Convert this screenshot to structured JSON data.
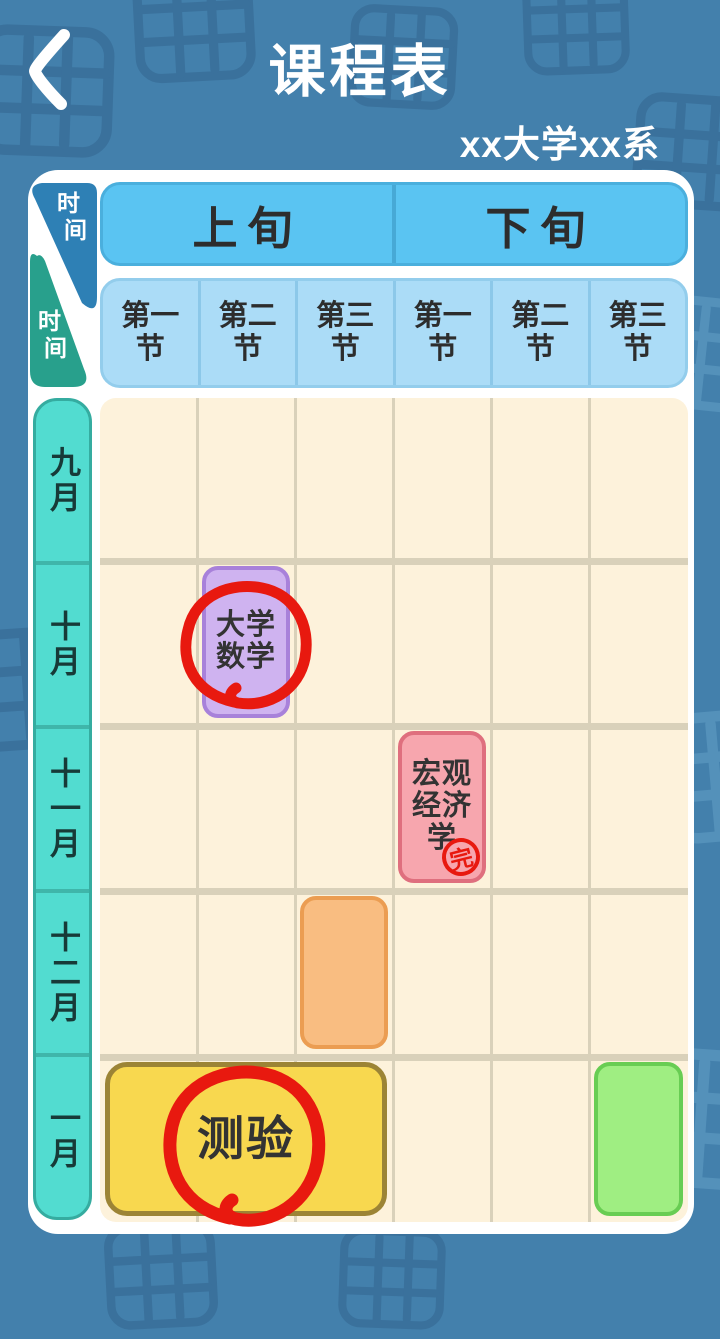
{
  "screen": {
    "title": "课程表",
    "subtitle": "xx大学xx系"
  },
  "colors": {
    "background": "#4380ac",
    "doodle_dark": "#3a719c",
    "doodle_light": "#63a0c7",
    "panel": "#ffffff",
    "group_header_fill": "#5ac4f2",
    "period_header_fill": "#abdcf7",
    "grid_fill": "#fdf2db",
    "grid_line": "#d9d1ba",
    "month_column_fill": "#52dcd0",
    "time_tab_blue": "#2e80b5",
    "time_tab_teal": "#28a08c",
    "annotation_red": "#e8190f"
  },
  "axis_tabs": [
    {
      "label_char1": "时",
      "label_char2": "间"
    },
    {
      "label_char1": "时",
      "label_char2": "间"
    }
  ],
  "group_headers": [
    {
      "label": "上旬"
    },
    {
      "label": "下旬"
    }
  ],
  "period_headers": [
    {
      "label": "第一\n节"
    },
    {
      "label": "第二\n节"
    },
    {
      "label": "第三\n节"
    },
    {
      "label": "第一\n节"
    },
    {
      "label": "第二\n节"
    },
    {
      "label": "第三\n节"
    }
  ],
  "months": [
    {
      "label": "九月"
    },
    {
      "label": "十月"
    },
    {
      "label": "十一月"
    },
    {
      "label": "十二月"
    },
    {
      "label": "一月"
    }
  ],
  "courses": [
    {
      "name": "大学数学",
      "label": "大学\n数学",
      "month": "十月",
      "group": "上旬",
      "period": "第二节",
      "fill": "#cfb3f0",
      "border": "#a881da",
      "annotation": "red-circle"
    },
    {
      "name": "宏观经济学",
      "label": "宏观\n经济\n学",
      "month": "十一月",
      "group": "下旬",
      "period": "第一节",
      "fill": "#f7a6ae",
      "border": "#df6f7e",
      "stamp": "完"
    },
    {
      "name": "",
      "label": "",
      "month": "十二月",
      "group": "上旬",
      "period": "第三节",
      "fill": "#f9bd81",
      "border": "#eb9d52"
    },
    {
      "name": "测验",
      "label": "测验",
      "month": "一月",
      "group": "上旬",
      "period": "第一节至第三节",
      "fill": "#f8d84f",
      "border": "#9c8435",
      "annotation": "red-circle"
    },
    {
      "name": "",
      "label": "",
      "month": "一月",
      "group": "下旬",
      "period": "第三节",
      "fill": "#9fee82",
      "border": "#68cd53"
    }
  ]
}
